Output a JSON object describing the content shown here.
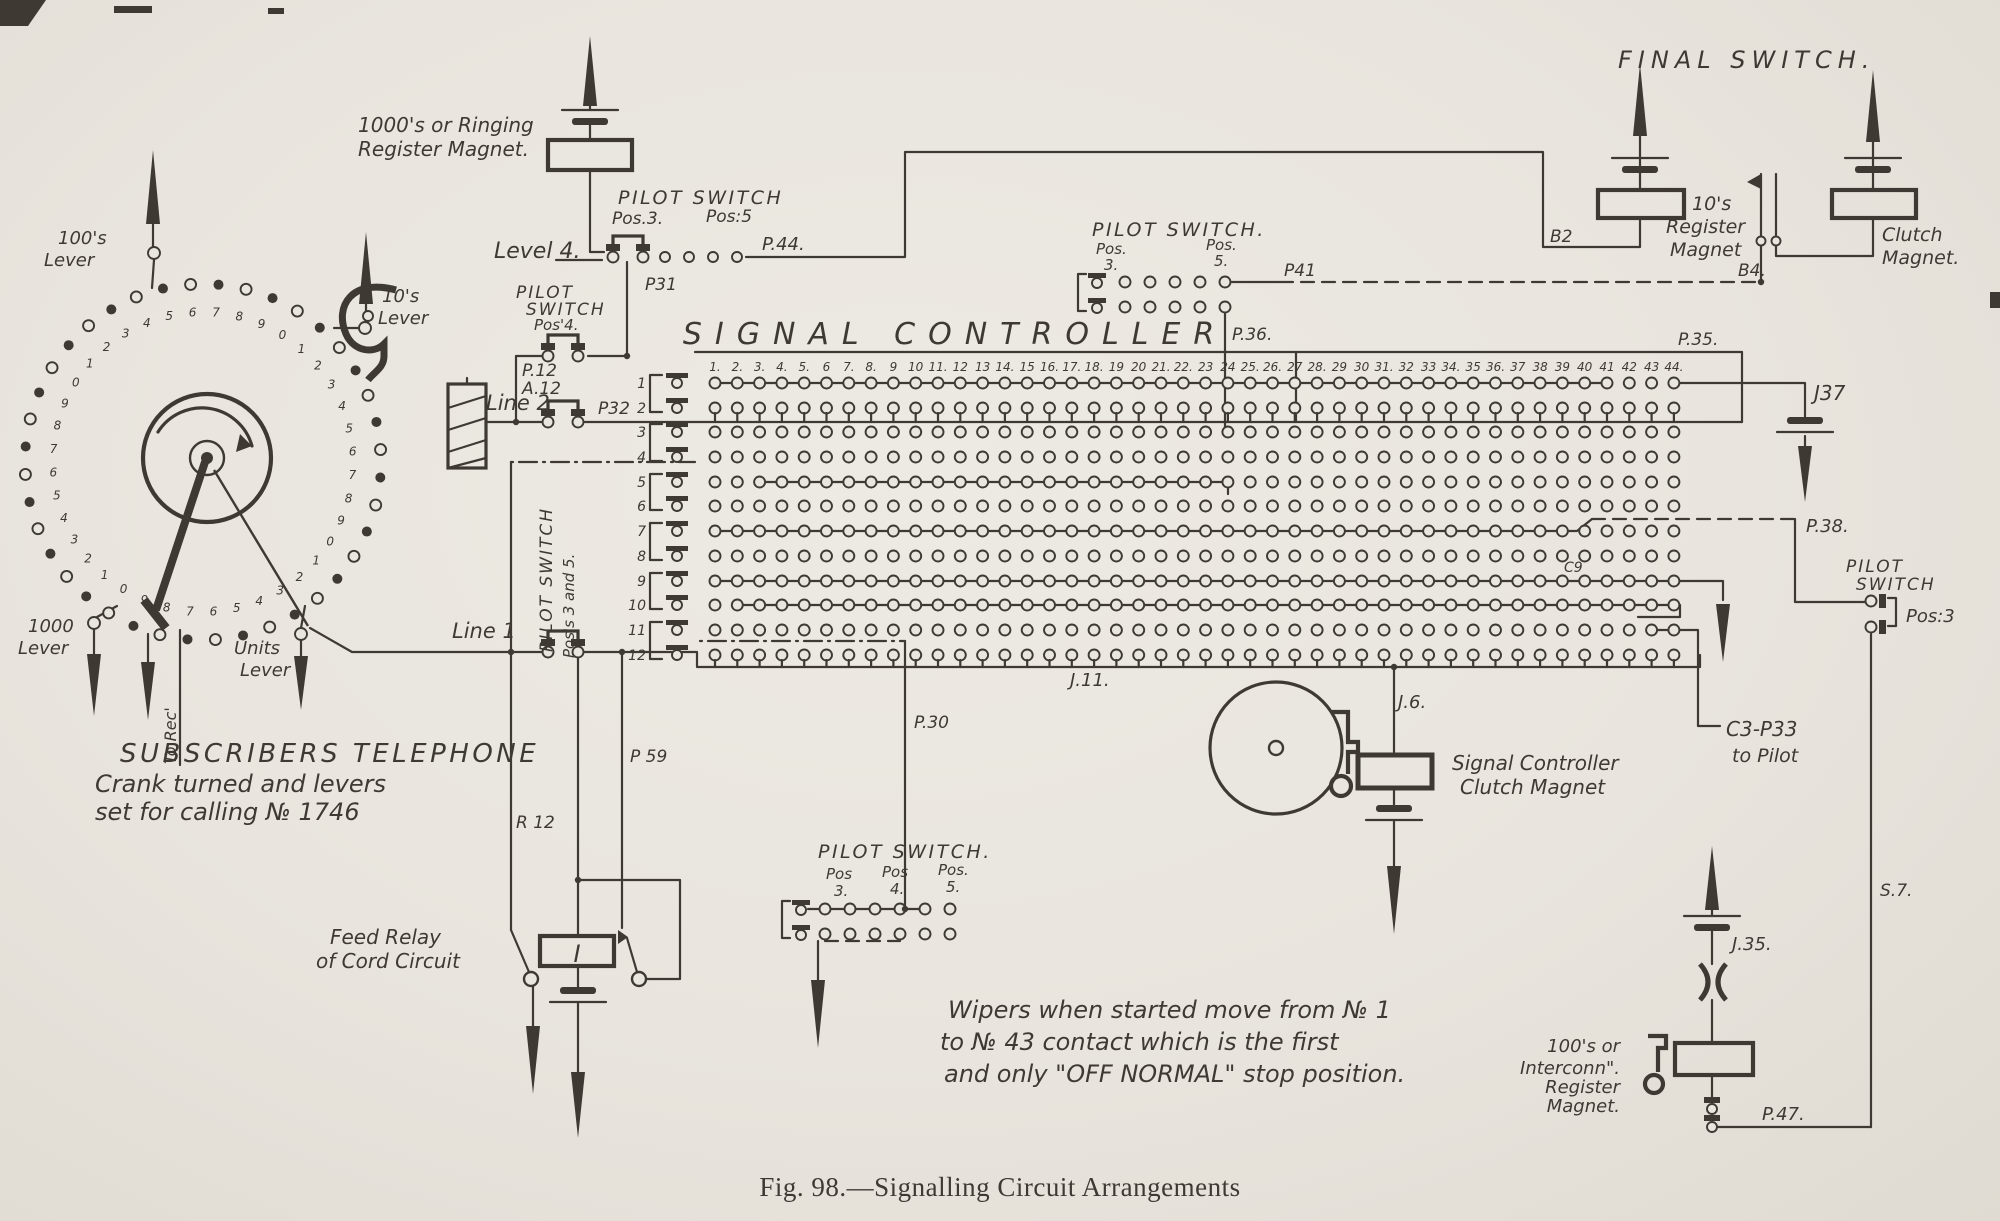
{
  "caption": "Fig. 98.—Signalling Circuit Arrangements",
  "title": "SIGNAL CONTROLLER",
  "final_switch": "FINAL SWITCH.",
  "ringing_magnet": {
    "line1": "1000's or Ringing",
    "line2": "Register Magnet."
  },
  "level4_switch": {
    "title": "PILOT SWITCH",
    "pos3": "Pos.3.",
    "pos5": "Pos:5",
    "level": "Level 4.",
    "p44": "P.44.",
    "p31": "P31"
  },
  "pos4_switch": {
    "line1": "PILOT",
    "line2": "SWITCH",
    "line3": "Pos'4.",
    "p12": "P.12",
    "a12": "A.12"
  },
  "line2": {
    "label": "Line 2",
    "p32": "P32"
  },
  "line1": {
    "label": "Line 1"
  },
  "mid_pilot_switch": {
    "title": "PILOT SWITCH.",
    "pos3a": "Pos.",
    "pos3b": "3.",
    "pos5a": "Pos.",
    "pos5b": "5.",
    "p41": "P41",
    "p36": "P.36."
  },
  "right_rail": {
    "p35": "P.35.",
    "j37": "J37",
    "p38": "P.38.",
    "pilot1": "PILOT",
    "pilot2": "SWITCH",
    "pos3": "Pos:3",
    "s7": "S.7.",
    "p47": "P.47."
  },
  "matrix": {
    "columns": [
      "1.",
      "2.",
      "3.",
      "4.",
      "5.",
      "6",
      "7.",
      "8.",
      "9",
      "10",
      "11.",
      "12",
      "13",
      "14.",
      "15",
      "16.",
      "17.",
      "18.",
      "19",
      "20",
      "21.",
      "22.",
      "23",
      "24",
      "25.",
      "26.",
      "27",
      "28.",
      "29",
      "30",
      "31.",
      "32",
      "33",
      "34.",
      "35",
      "36.",
      "37",
      "38",
      "39",
      "40",
      "41",
      "42",
      "43",
      "44."
    ],
    "rows": [
      "1",
      "2",
      "3",
      "4",
      "5",
      "6",
      "7",
      "8",
      "9",
      "10",
      "11",
      "12"
    ],
    "j11": "J.11.",
    "c9": "C9",
    "c3p33a": "C3-P33",
    "c3p33b": "to Pilot"
  },
  "clutch_assembly": {
    "j6": "J.6.",
    "label1": "Signal Controller",
    "label2": "Clutch Magnet"
  },
  "final_assembly": {
    "b2": "B2",
    "b4": "B4.",
    "reg1": "10's",
    "reg2": "Register",
    "reg3": "Magnet",
    "clutch1": "Clutch",
    "clutch2": "Magnet."
  },
  "bottom_pilot_switch": {
    "title": "PILOT SWITCH.",
    "pos3a": "Pos",
    "pos3b": "3.",
    "pos4a": "Pos",
    "pos4b": "4.",
    "pos5a": "Pos.",
    "pos5b": "5.",
    "p30": "P.30"
  },
  "feed_relay": {
    "label1": "Feed Relay",
    "label2": "of Cord Circuit",
    "r12": "R 12",
    "p59": "P 59",
    "relay": "I"
  },
  "pos35_switch": {
    "line1": "PILOT SWITCH",
    "line2": "Pos's 3 and 5."
  },
  "interconn_magnet": {
    "line1": "100's or",
    "line2": "Interconn\".",
    "line3": "Register",
    "line4": "Magnet.",
    "j35": "J.35."
  },
  "telephone": {
    "caption1": "SUBSCRIBERS TELEPHONE",
    "caption2": "Crank turned and levers",
    "caption3": "set for calling № 1746",
    "lever100a": "100's",
    "lever100b": "Lever",
    "lever10a": "10's",
    "lever10b": "Lever",
    "lever1000a": "1000",
    "lever1000b": "Lever",
    "leverUnitsA": "Units",
    "leverUnitsB": "Lever",
    "to_rec": "To Rec'",
    "dial_digits": [
      "7",
      "8",
      "9",
      "0",
      "1",
      "2",
      "3",
      "4",
      "5",
      "6",
      "7",
      "8",
      "9",
      "0",
      "1",
      "2",
      "3",
      "4",
      "5",
      "6",
      "7",
      "8",
      "9",
      "0",
      "1",
      "2",
      "3",
      "4",
      "5",
      "6",
      "7",
      "8",
      "9",
      "0",
      "1",
      "2",
      "3",
      "4",
      "5",
      "6"
    ]
  },
  "note": {
    "line1": "Wipers when started move from № 1",
    "line2": "to № 43 contact which is the first",
    "line3": "and only \"OFF NORMAL\" stop position."
  }
}
